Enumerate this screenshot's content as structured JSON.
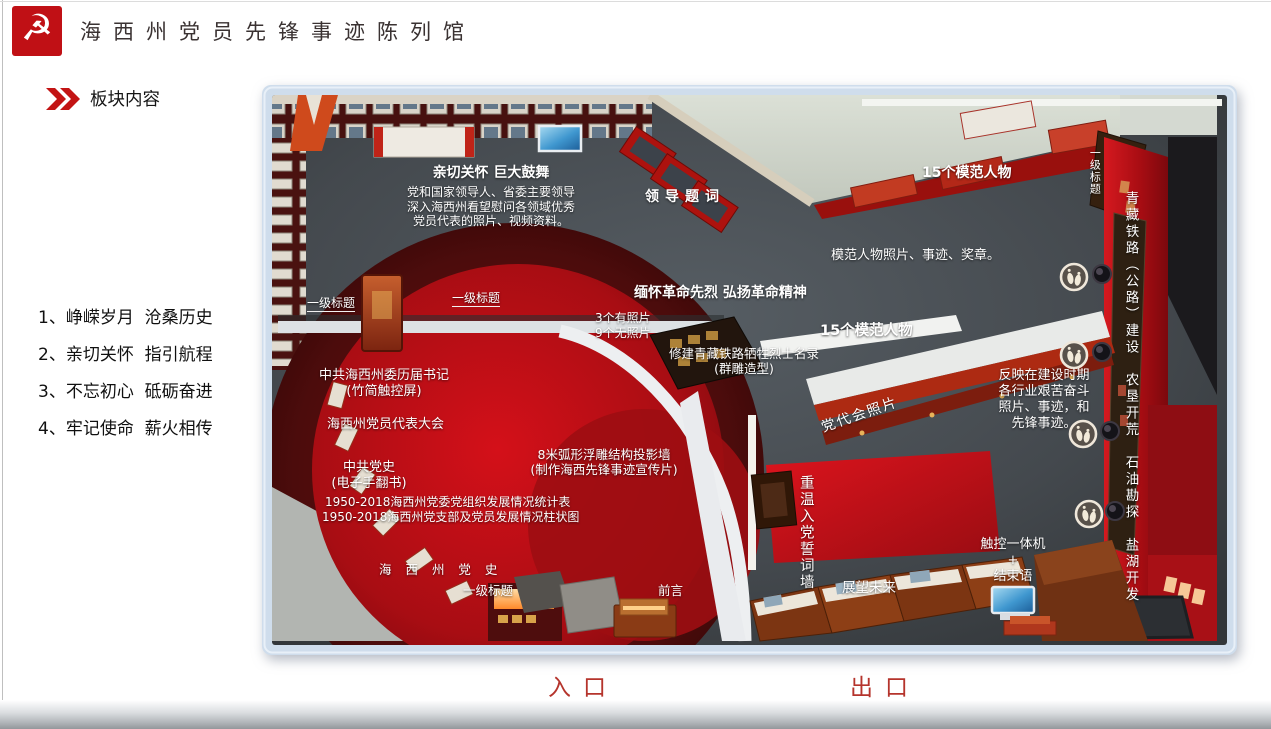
{
  "header": {
    "title": "海西州党员先锋事迹陈列馆"
  },
  "icons": {
    "logo_glyph": "☭",
    "logo_name": "party-emblem-icon",
    "section_marker": "double-chevron-icon",
    "footprint_marker": "footprint-icon"
  },
  "section": {
    "title": "板块内容"
  },
  "plate_list": {
    "items": [
      "1、峥嵘岁月  沧桑历史",
      "2、亲切关怀  指引航程",
      "3、不忘初心  砥砺奋进",
      "4、牢记使命  薪火相传"
    ]
  },
  "floorplan": {
    "labels": {
      "qinqie_title": "亲切关怀 巨大鼓舞",
      "qinqie_line1": "党和国家领导人、省委主要领导",
      "qinqie_line2": "深入海西州看望慰问各领域优秀",
      "qinqie_line3": "党员代表的照片、视频资料。",
      "lingdao_tici": "领导题词",
      "mofan_top": "15个模范人物",
      "yiji_right": "一级标题",
      "mofan_desc": "模范人物照片、事迹、奖章。",
      "mianhuai": "缅怀革命先烈  弘扬革命精神",
      "photos_with": "3个有照片",
      "photos_without": "9个无照片",
      "xiujian": "修建青藏铁路牺牲烈士名录",
      "qundiao": "(群雕造型)",
      "mofan_mid": "15个模范人物",
      "yiji_left1": "一级标题",
      "yiji_left2": "一级标题",
      "shuji": "中共海西州委历届书记",
      "zhujian": "(竹简触控屏)",
      "daibiao_dahui": "海西州党员代表大会",
      "dangshi": "中共党史",
      "shoufanshu": "(电子手翻书)",
      "tongji": "1950-2018海西州党委党组织发展情况统计表",
      "zhuzhuang": "1950-2018海西州党支部及党员发展情况柱状图",
      "huxing": "8米弧形浮雕结构投影墙",
      "xuanchuan": "(制作海西先锋事迹宣传片)",
      "haixi_dangshi": "海 西 州 党 史",
      "yiji_bottom": "一级标题",
      "qianyan": "前言",
      "fanying": "反映在建设时期\n各行业艰苦奋斗\n照片、事迹，和\n先锋事迹。",
      "qingzang": "青藏铁路（公路）建设　农垦开荒　石油勘探　盐湖开发",
      "chongwen": "重温入党誓词墙",
      "zhanwang": "展望未来",
      "chukong": "触控一体机",
      "plus": "+",
      "jieshuyu": "结束语",
      "dangdaihui": "党代会照片"
    },
    "entrance": "入口",
    "exit": "出口"
  },
  "colors": {
    "accent_red": "#c01015",
    "frame_blue": "#cfddec",
    "floor_dark": "#43484d",
    "carpet_red": "#c01018",
    "gate_label": "#b5342c"
  }
}
